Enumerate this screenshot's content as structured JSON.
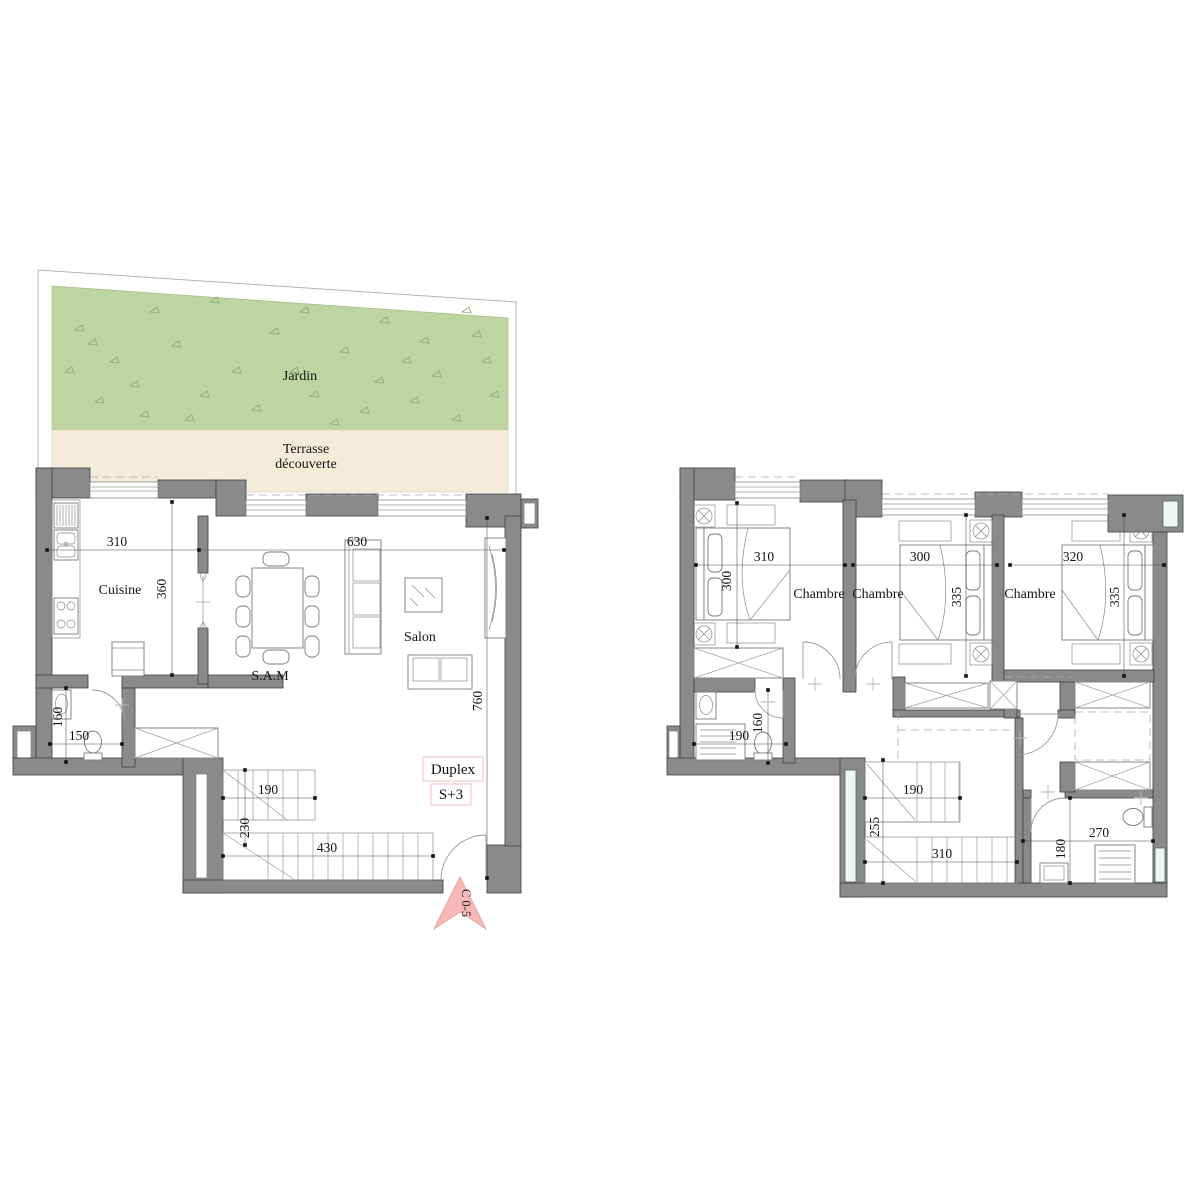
{
  "title": "Duplex S+3 floor plan",
  "colors": {
    "wall": "#8a8a8d",
    "garden": "#bdd5a1",
    "terrace": "#f4ebd9",
    "entry_arrow": "#f6b9b7",
    "badge_border": "#f2caca"
  },
  "ground_floor": {
    "garden": {
      "label": "Jardin"
    },
    "terrace": {
      "label_line1": "Terrasse",
      "label_line2": "découverte"
    },
    "kitchen": {
      "label": "Cuisine",
      "width": "310",
      "depth": "360"
    },
    "wc": {
      "depth": "160",
      "width": "150"
    },
    "dining": {
      "label": "S.A.M"
    },
    "living": {
      "label": "Salon",
      "width": "630",
      "depth": "760"
    },
    "stairs": {
      "top_run": "190",
      "mid": "230",
      "bottom_run": "430"
    },
    "unit_badge": {
      "line1": "Duplex",
      "line2": "S+3"
    },
    "entry": {
      "label": "C 0-5"
    }
  },
  "upper_floor": {
    "bedrooms": [
      {
        "label": "Chambre",
        "width": "310",
        "depth": "300"
      },
      {
        "label": "Chambre",
        "width": "300",
        "depth": "335"
      },
      {
        "label": "Chambre",
        "width": "320",
        "depth": "335"
      }
    ],
    "bathroom": {
      "width": "190",
      "depth": "160"
    },
    "stairs": {
      "top_run": "190",
      "mid": "255",
      "bottom_run": "310"
    },
    "shower_room": {
      "width": "270",
      "depth": "180"
    }
  }
}
